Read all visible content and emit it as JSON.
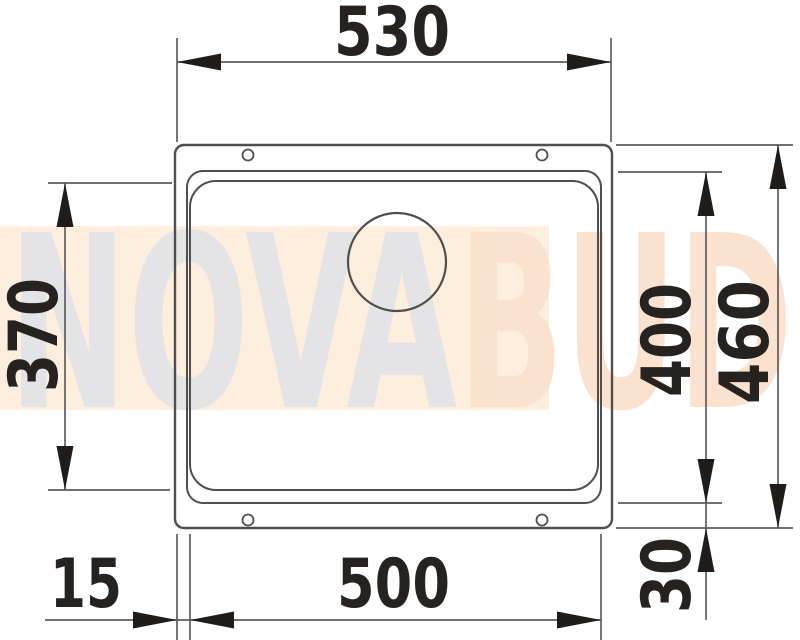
{
  "watermark": {
    "text_left": "NOVA",
    "text_right": "BUD",
    "band_color": "#fdeede",
    "left_text_color": "#e4e4e7",
    "right_text_color": "#fbe2cf"
  },
  "drawing": {
    "outline_color": "#4f4f4f",
    "dim_line_color": "#5d5d5d",
    "arrow_color": "#1f1c1a",
    "text_color": "#262220",
    "dims": {
      "overall_width": "530",
      "bowl_inner_depth": "370",
      "bowl_depth": "400",
      "overall_depth": "460",
      "rim_offset_left": "15",
      "bowl_width": "500",
      "rim_offset_bottom": "30"
    }
  }
}
